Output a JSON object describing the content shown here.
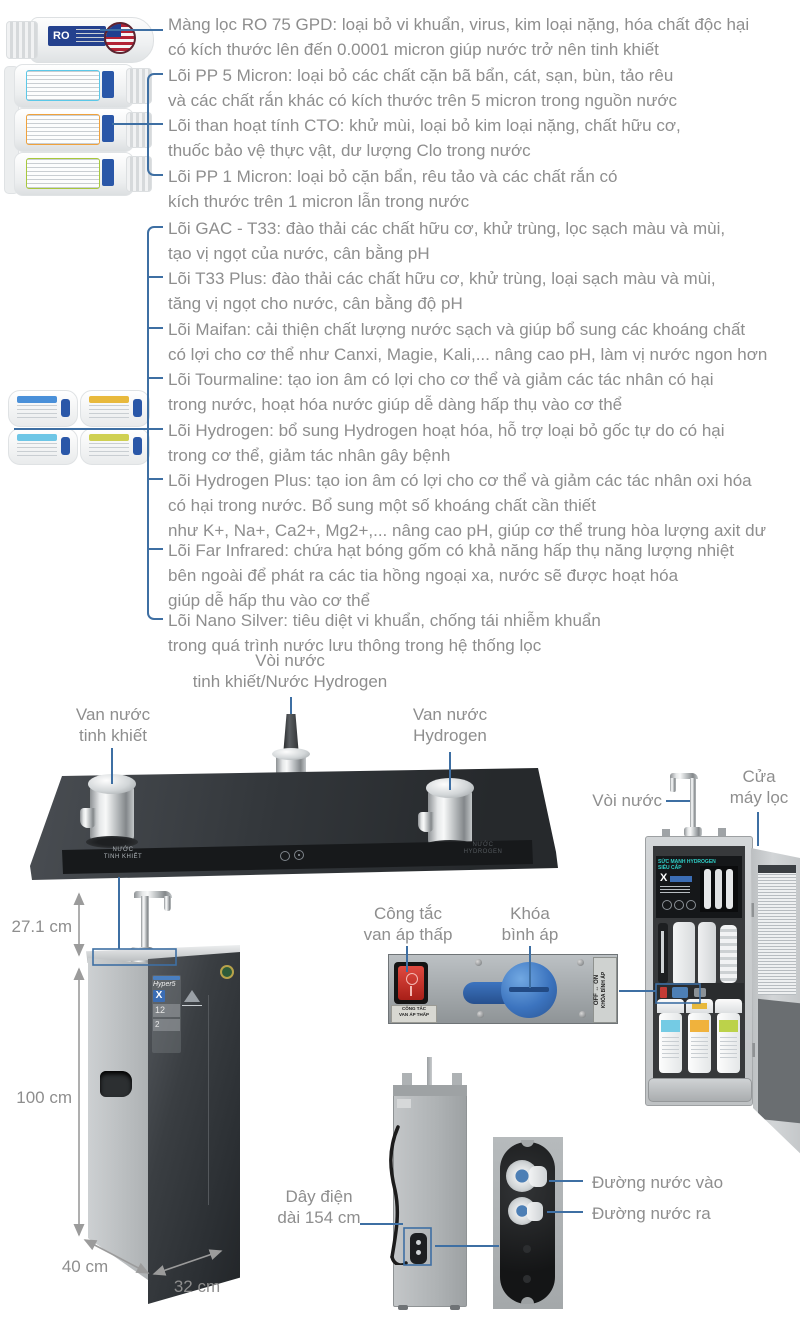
{
  "colors": {
    "connector_blue": "#3e6fa3",
    "text_gray": "#8e8e8e",
    "dimension_gray": "#9b9b9b",
    "cabinet_title_teal": "#2fd0c8",
    "valve_knob_blue": "#3c74bf",
    "switch_red": "#d23028"
  },
  "filter_section": {
    "items": [
      {
        "id": "ro-membrane",
        "text": "Màng lọc RO 75 GPD: loại bỏ vi khuẩn, virus, kim loại nặng, hóa chất độc hại\ncó kích thước lên đến 0.0001 micron giúp nước trở nên tinh khiết"
      },
      {
        "id": "pp-5-micron",
        "text": "Lõi PP 5 Micron: loại bỏ các chất cặn bã bẩn, cát, sạn, bùn, tảo rêu\nvà các chất rắn khác có kích thước trên 5 micron trong nguồn nước"
      },
      {
        "id": "cto",
        "text": "Lõi than hoạt tính CTO: khử mùi, loại bỏ kim loại nặng, chất hữu cơ,\nthuốc bảo vệ thực vật, dư lượng Clo trong nước"
      },
      {
        "id": "pp-1-micron",
        "text": "Lõi PP 1 Micron: loại bỏ cặn bẩn, rêu tảo và các chất rắn có\nkích thước trên 1 micron lẫn trong nước"
      },
      {
        "id": "gac-t33",
        "text": "Lõi GAC - T33: đào thải các chất hữu cơ, khử trùng, lọc sạch màu và mùi,\ntạo vị ngọt của nước, cân bằng pH"
      },
      {
        "id": "t33-plus",
        "text": "Lõi T33 Plus: đào thải các chất hữu cơ, khử trùng, loại sạch màu và mùi,\ntăng vị ngọt cho nước, cân bằng độ pH"
      },
      {
        "id": "maifan",
        "text": "Lõi Maifan: cải thiện chất lượng nước sạch và giúp bổ sung các khoáng chất\ncó lợi cho cơ thể như Canxi, Magie, Kali,... nâng cao pH, làm vị nước ngon hơn"
      },
      {
        "id": "tourmaline",
        "text": "Lõi Tourmaline: tạo ion âm có lợi cho cơ thể và giảm các tác nhân có hại\ntrong nước, hoạt hóa nước giúp dễ dàng hấp thụ vào cơ thể"
      },
      {
        "id": "hydrogen",
        "text": "Lõi Hydrogen: bổ sung Hydrogen hoạt hóa, hỗ trợ loại bỏ gốc tự do có hại\ntrong cơ thể, giảm tác nhân gây bệnh"
      },
      {
        "id": "hydrogen-plus",
        "text": "Lõi Hydrogen Plus: tạo ion âm có lợi cho cơ thể và giảm các tác nhân oxi hóa\ncó hại trong nước. Bổ sung một số khoáng chất cần thiết\nnhư K+, Na+, Ca2+, Mg2+,... nâng cao pH, giúp cơ thể trung hòa lượng axit dư"
      },
      {
        "id": "far-infrared",
        "text": "Lõi Far Infrared: chứa hạt bóng gốm có khả năng hấp thụ năng lượng nhiệt\nbên ngoài để phát ra các tia hồng ngoại xa, nước sẽ được hoạt hóa\ngiúp dễ hấp thu vào cơ thể"
      },
      {
        "id": "nano-silver",
        "text": "Lõi Nano Silver: tiêu diệt vi khuẩn, chống tái nhiễm khuẩn\ntrong quá trình nước lưu thông trong hệ thống lọc"
      }
    ],
    "ro_label": "RO"
  },
  "faucet_assembly": {
    "top_label": "Vòi nước\ntinh khiết/Nước Hydrogen",
    "left_label": "Van nước\ntinh khiết",
    "right_label": "Van nước\nHydrogen",
    "strip_left": "NƯỚC\nTINH KHIẾT",
    "strip_right": "NƯỚC\nHYDROGEN"
  },
  "annotations": {
    "faucet_right": "Vòi nước",
    "door": "Cửa\nmáy lọc",
    "switch": "Công tắc\nvan áp thấp",
    "valve": "Khóa\nbình áp",
    "power_cord": "Dây điện\ndài 154 cm",
    "port_in": "Đường nước vào",
    "port_out": "Đường nước ra"
  },
  "dimensions": {
    "spout_height": "27.1 cm",
    "body_height": "100 cm",
    "depth": "40 cm",
    "width": "32 cm"
  },
  "valve_panel": {
    "switch_sticker": "CÔNG TẮC\nVAN ÁP THẤP",
    "side_sticker_line1": "OFF ↔ ON",
    "side_sticker_line2": "KHÓA BÌNH ÁP"
  },
  "machine": {
    "badge_brand": "Hyper5",
    "badge_model": "X",
    "badge_stage": "12",
    "badge_mode": "2"
  },
  "cabinet": {
    "panel_title": "SỨC MẠNH HYDROGEN SIÊU CẤP",
    "panel_logo": "X"
  }
}
